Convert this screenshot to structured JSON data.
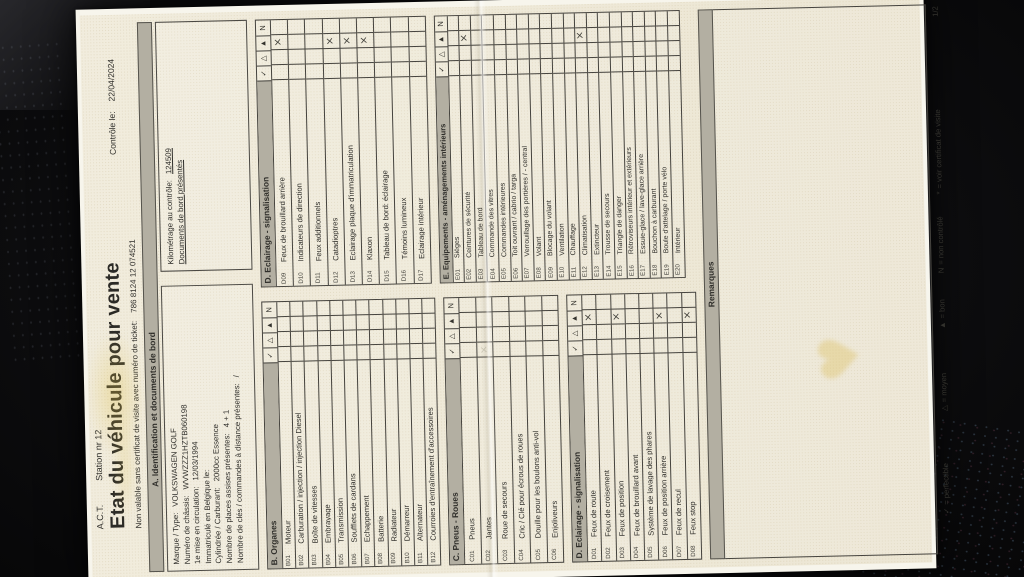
{
  "header": {
    "act": "A.C.T.",
    "station": "Station nr 12",
    "title": "Etat du véhicule pour vente",
    "controle_label": "Contrôle le:",
    "controle_date": "22/04/2024",
    "ticket_label": "Non valable sans certificat de visite avec numéro de ticket:",
    "ticket_number": "786 8124 12 074521"
  },
  "section_a": {
    "title": "A. Identification et documents de bord",
    "ident_rows": [
      {
        "label": "Marque / Type:",
        "value": "VOLKSWAGEN GOLF"
      },
      {
        "label": "Numéro de châssis:",
        "value": "WVWZZZ1HZTB060198"
      },
      {
        "label": "1e mise en circulation:",
        "value": "12/03/1994"
      },
      {
        "label": "Immatriculé en Belgique le:",
        "value": ""
      },
      {
        "label": "",
        "value": ""
      },
      {
        "label": "Cylindrée / Carburant:",
        "value": "2000cc  Essence"
      },
      {
        "label": "Nombre de places assises présentes:",
        "value": "4 + 1"
      },
      {
        "label": "Nombre de clés / commandes à distance présentes:",
        "value": "/"
      }
    ],
    "km_label": "Kilométrage au contrôle:",
    "km_value": "124509",
    "docs_line": "Documents de bord présentés"
  },
  "mark_columns": [
    {
      "key": "perfectible",
      "symbol": "✓"
    },
    {
      "key": "moyen",
      "symbol": "△"
    },
    {
      "key": "bon",
      "symbol": "▲"
    },
    {
      "key": "noncontrole",
      "symbol": "N"
    }
  ],
  "mark_symbol": "×",
  "layout_columns": {
    "left": [
      "B",
      "C",
      "D1"
    ],
    "right": [
      "D2",
      "E"
    ]
  },
  "sections": {
    "B": {
      "title": "B. Organes",
      "items": [
        {
          "code": "B01",
          "label": "Moteur",
          "mark": null
        },
        {
          "code": "B02",
          "label": "Carburation / injection / injection Diesel",
          "mark": null
        },
        {
          "code": "B03",
          "label": "Boîte de vitesses",
          "mark": null
        },
        {
          "code": "B04",
          "label": "Embrayage",
          "mark": null
        },
        {
          "code": "B05",
          "label": "Transmission",
          "mark": null
        },
        {
          "code": "B06",
          "label": "Soufflets de cardans",
          "mark": null
        },
        {
          "code": "B07",
          "label": "Echappement",
          "mark": null
        },
        {
          "code": "B08",
          "label": "Batterie",
          "mark": null
        },
        {
          "code": "B09",
          "label": "Radiateur",
          "mark": null
        },
        {
          "code": "B10",
          "label": "Démarreur",
          "mark": null
        },
        {
          "code": "B11",
          "label": "Alternateur",
          "mark": null
        },
        {
          "code": "B12",
          "label": "Courroies d'entraînement d'accessoires",
          "mark": null
        }
      ]
    },
    "C": {
      "title": "C. Pneus - Roues",
      "items": [
        {
          "code": "C01",
          "label": "Pneus",
          "mark": null
        },
        {
          "code": "C02",
          "label": "Jantes",
          "mark": "perfectible",
          "faint": true
        },
        {
          "code": "C03",
          "label": "Roue de secours",
          "mark": null
        },
        {
          "code": "C04",
          "label": "Cric / Clé pour écrous de roues",
          "mark": null
        },
        {
          "code": "C05",
          "label": "Douille pour les boulons anti-vol",
          "mark": null
        },
        {
          "code": "C06",
          "label": "Enjoliveurs",
          "mark": null
        }
      ]
    },
    "D1": {
      "title": "D. Eclairage - signalisation",
      "items": [
        {
          "code": "D01",
          "label": "Feux de route",
          "mark": "bon"
        },
        {
          "code": "D02",
          "label": "Feux de croisement",
          "mark": null
        },
        {
          "code": "D03",
          "label": "Feux de position",
          "mark": "bon"
        },
        {
          "code": "D04",
          "label": "Feux de brouillard avant",
          "mark": null
        },
        {
          "code": "D05",
          "label": "Système de lavage des phares",
          "mark": null
        },
        {
          "code": "D06",
          "label": "Feux de position arrière",
          "mark": "bon"
        },
        {
          "code": "D07",
          "label": "Feux de recul",
          "mark": null
        },
        {
          "code": "D08",
          "label": "Feux stop",
          "mark": "bon"
        }
      ]
    },
    "D2": {
      "title": "D. Eclairage - signalisation",
      "items": [
        {
          "code": "D09",
          "label": "Feux de brouillard arrière",
          "mark": "bon"
        },
        {
          "code": "D10",
          "label": "Indicateurs de direction",
          "mark": null
        },
        {
          "code": "D11",
          "label": "Feux additionnels",
          "mark": null
        },
        {
          "code": "D12",
          "label": "Catadioptres",
          "mark": "bon"
        },
        {
          "code": "D13",
          "label": "Eclairage plaque d'immatriculation",
          "mark": "bon"
        },
        {
          "code": "D14",
          "label": "Klaxon",
          "mark": "bon"
        },
        {
          "code": "D15",
          "label": "Tableau de bord: éclairage",
          "mark": null
        },
        {
          "code": "D16",
          "label": "Témoins lumineux",
          "mark": null
        },
        {
          "code": "D17",
          "label": "Eclairage intérieur",
          "mark": null
        }
      ]
    },
    "E": {
      "title": "E. Equipements - aménagements intérieurs",
      "items": [
        {
          "code": "E01",
          "label": "Sièges",
          "mark": null
        },
        {
          "code": "E02",
          "label": "Ceintures de sécurité",
          "mark": "bon"
        },
        {
          "code": "E03",
          "label": "Tableau de bord",
          "mark": null
        },
        {
          "code": "E04",
          "label": "Commande des vitres",
          "mark": null
        },
        {
          "code": "E05",
          "label": "Commandes intérieures",
          "mark": null
        },
        {
          "code": "E06",
          "label": "Toit ouvrant / cabrio / targa",
          "mark": null
        },
        {
          "code": "E07",
          "label": "Verrouillage des portières / - central",
          "mark": null
        },
        {
          "code": "E08",
          "label": "Volant",
          "mark": null
        },
        {
          "code": "E09",
          "label": "Blocage du volant",
          "mark": null
        },
        {
          "code": "E10",
          "label": "Ventilation",
          "mark": null
        },
        {
          "code": "E11",
          "label": "Chauffage",
          "mark": null
        },
        {
          "code": "E12",
          "label": "Climatisation",
          "mark": "bon"
        },
        {
          "code": "E13",
          "label": "Extincteur",
          "mark": null
        },
        {
          "code": "E14",
          "label": "Trousse de secours",
          "mark": null
        },
        {
          "code": "E15",
          "label": "Triangle de danger",
          "mark": null
        },
        {
          "code": "E16",
          "label": "Rétroviseurs intérieur et extérieurs",
          "mark": null
        },
        {
          "code": "E17",
          "label": "Essuie-glace / lave-glace arrière",
          "mark": null
        },
        {
          "code": "E18",
          "label": "Bouchon à carburant",
          "mark": null
        },
        {
          "code": "E19",
          "label": "Boule d'attelage / porte vélo",
          "mark": null
        },
        {
          "code": "E20",
          "label": "Intérieur",
          "mark": null
        }
      ]
    }
  },
  "remarques": {
    "title": "Remarques"
  },
  "footer": {
    "legend": [
      {
        "symbol": "✓",
        "label": "= perfectible"
      },
      {
        "symbol": "△",
        "label": "= moyen"
      },
      {
        "symbol": "▲",
        "label": "= bon"
      },
      {
        "symbol": "N",
        "label": "= non contrôlé"
      },
      {
        "symbol": "*",
        "label": "= voir certificat de visite"
      }
    ],
    "page": "1/2"
  },
  "stains": {
    "heart_glyph": "♥"
  }
}
